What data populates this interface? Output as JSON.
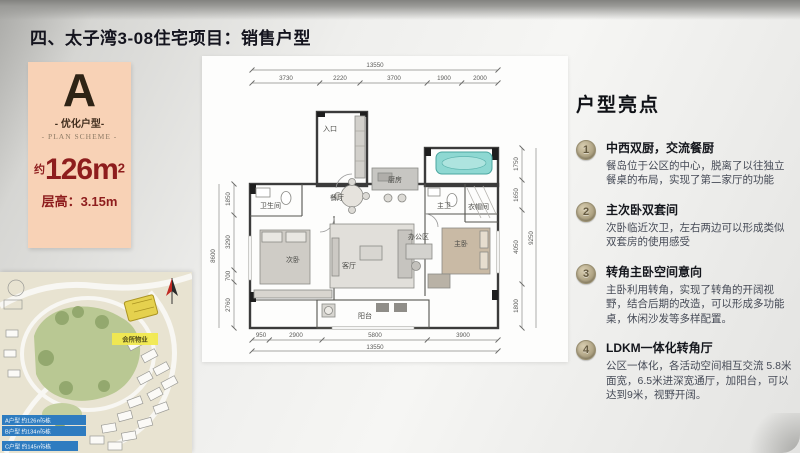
{
  "page": {
    "title": "四、太子湾3-08住宅项目：销售户型"
  },
  "plan_badge": {
    "letter": "A",
    "subtitle": "- 优化户型-",
    "subtitle_en": "- PLAN SCHEME -",
    "area_prefix": "约",
    "area_value": "126m",
    "area_sup": "2",
    "floor_height": "层高：3.15m"
  },
  "floor_plan": {
    "rooms": {
      "entrance": "入口",
      "bath2": "卫生间",
      "bedroom2": "次卧",
      "dining": "餐厅",
      "kitchen": "厨房",
      "office": "办公区",
      "living": "客厅",
      "balcony": "阳台",
      "master_bath": "主卫",
      "closet": "衣帽间",
      "master_bedroom": "主卧"
    },
    "dims": {
      "top_total": "13550",
      "top": [
        "3730",
        "2220",
        "3700",
        "1900",
        "2000"
      ],
      "bottom": [
        "950",
        "2900",
        "5800",
        "3900"
      ],
      "bottom_total": "13550",
      "left_total": "8600",
      "left": [
        "1850",
        "3290",
        "700",
        "2760"
      ],
      "right_total": "9250",
      "right": [
        "1750",
        "1650",
        "4050",
        "1800"
      ]
    }
  },
  "highlights": {
    "title": "户型亮点",
    "items": [
      {
        "num": "1",
        "title": "中西双厨，交流餐厨",
        "desc": "餐岛位于公区的中心，脱离了以往独立餐桌的布局，实现了第二家厅的功能"
      },
      {
        "num": "2",
        "title": "主次卧双套间",
        "desc": "次卧临近次卫，左右两边可以形成类似双套房的使用感受"
      },
      {
        "num": "3",
        "title": "转角主卧空间意向",
        "desc": "主卧利用转角，实现了转角的开阔视野，结合后期的改造，可以形成多功能桌，休闲沙发等多样配置。"
      },
      {
        "num": "4",
        "title": "LDKM一体化转角厅",
        "desc": "公区一体化，各活动空间相互交流 5.8米面宽，6.5米进深宽通厅，加阳台，可以达到9米，视野开阔。"
      }
    ]
  },
  "site_map": {
    "building_tag": "会所物业",
    "legend": [
      "A户型 约126㎡5栋",
      "B户型 约134㎡5栋",
      "C户型 约145㎡5栋"
    ]
  },
  "colors": {
    "badge_bg": "#f8d2b6",
    "accent_red": "#8e1d1d",
    "coin_gold": "#ab9f7f",
    "legend_blue": "#2e7cc0",
    "map_yellow": "#f1e94f",
    "park_green": "#b9c893",
    "bathtub_teal": "#8ed8d2"
  }
}
